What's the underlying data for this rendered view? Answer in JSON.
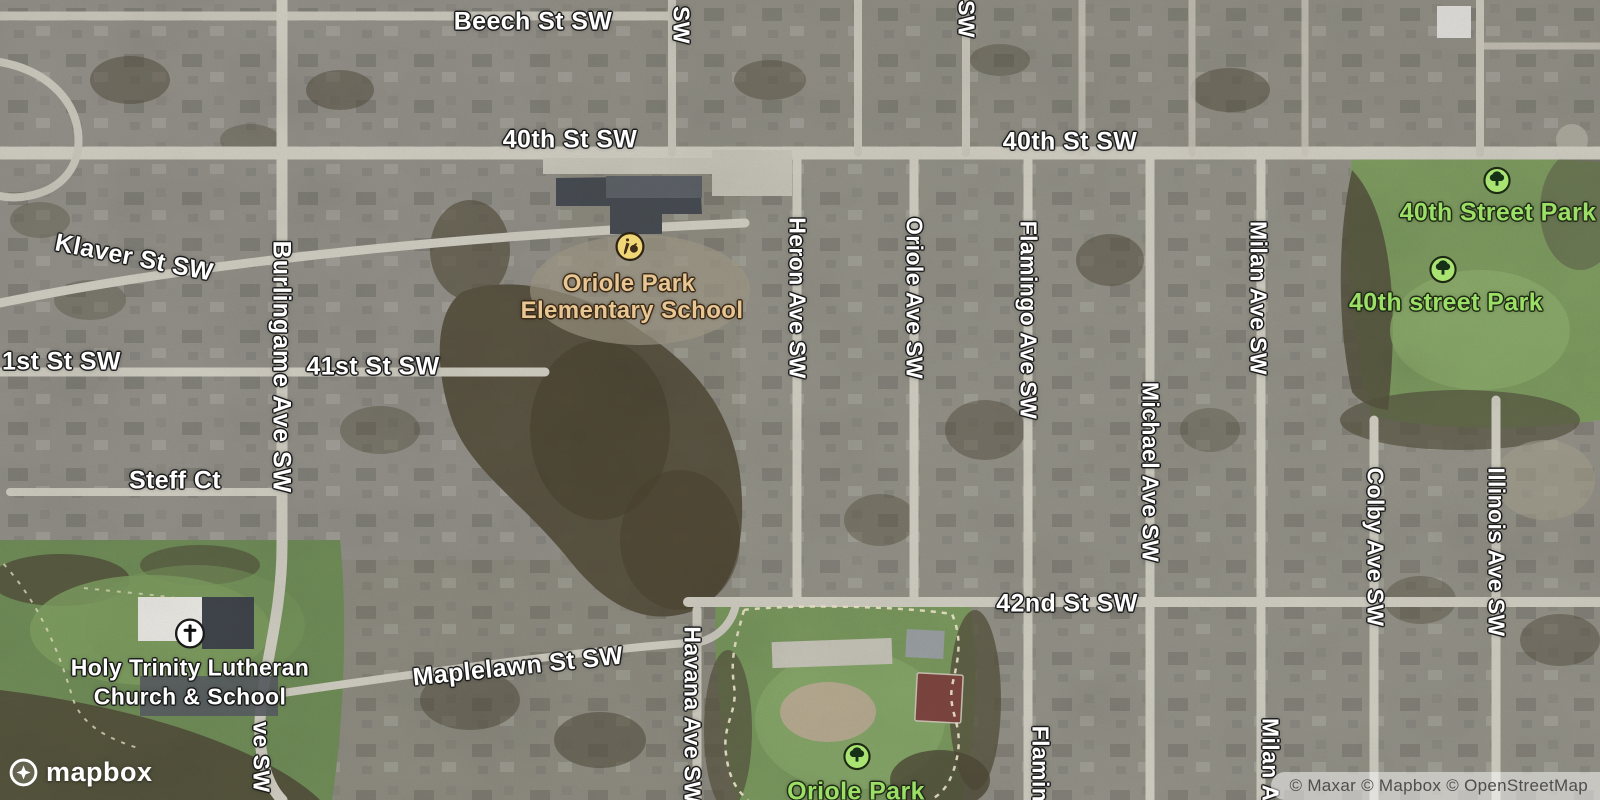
{
  "map": {
    "attribution": "© Maxar © Mapbox © OpenStreetMap",
    "logo_text": "mapbox",
    "colors": {
      "street_label": "#ffffff",
      "park_label": "#9bdf66",
      "school_label": "#e8c795",
      "park_icon_fill": "#a9e472",
      "school_icon_fill": "#f1d678",
      "church_icon_fill": "#ffffff",
      "road_fill": "#d0cdc2",
      "attribution_text": "#4e4e4e"
    }
  },
  "streets": {
    "beech": "Beech St SW",
    "fortieth_west": "40th St SW",
    "fortieth_east": "40th St SW",
    "sw_partial_top1": "SW",
    "sw_partial_top2": "SW",
    "klaver": "Klaver St SW",
    "burlingame": "Burlingame Ave SW",
    "first_partial": "1st St SW",
    "fortyfirst": "41st St SW",
    "steff": "Steff Ct",
    "heron": "Heron Ave SW",
    "oriole_ave": "Oriole Ave SW",
    "flamingo": "Flamingo Ave SW",
    "milan": "Milan Ave SW",
    "michael": "Michael Ave SW",
    "colby": "Colby Ave SW",
    "illinois": "Illinois Ave SW",
    "fortysecond": "42nd St SW",
    "maplelawn": "Maplelawn St SW",
    "havana": "Havana Ave SW",
    "burlingame_partial_bottom": "ve SW",
    "flamingo_partial_bottom": "Flamin",
    "milan_partial_bottom": "Milan Av"
  },
  "pois": {
    "school": {
      "line1": "Oriole Park",
      "line2": "Elementary School",
      "icon": "school-icon"
    },
    "church": {
      "line1": "Holy Trinity Lutheran",
      "line2": "Church & School",
      "icon": "church-icon"
    },
    "park_40th_1": {
      "name": "40th Street Park",
      "icon": "park-tree-icon"
    },
    "park_40th_2": {
      "name": "40th street Park",
      "icon": "park-tree-icon"
    },
    "park_oriole": {
      "name": "Oriole Park",
      "icon": "park-tree-icon"
    }
  }
}
